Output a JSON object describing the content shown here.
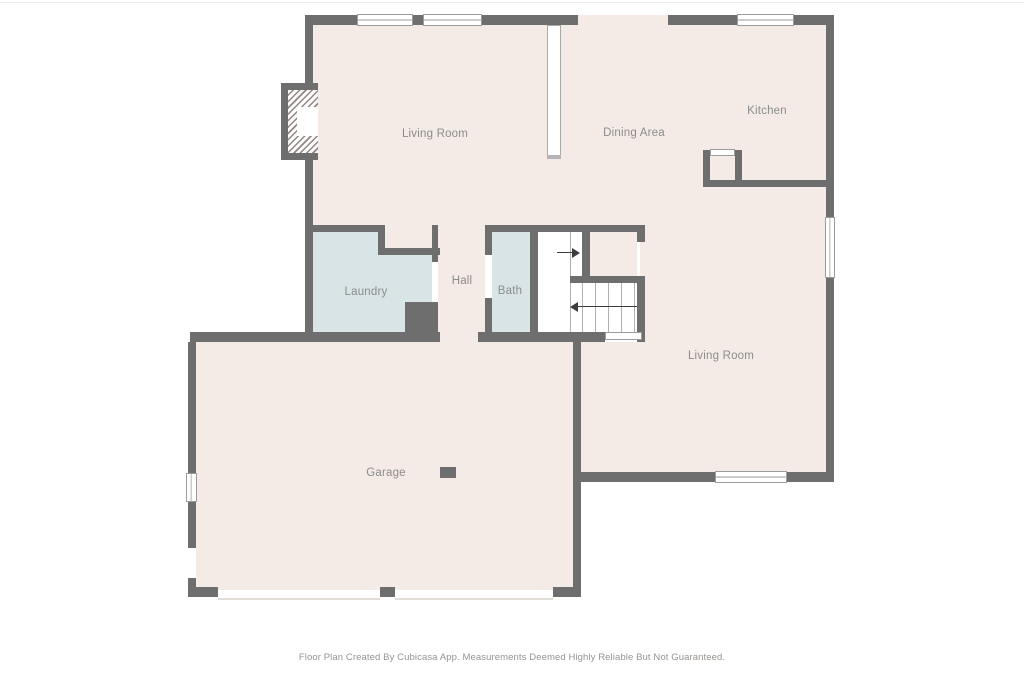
{
  "rooms": {
    "living_room_main": {
      "label": "Living Room"
    },
    "dining_area": {
      "label": "Dining Area"
    },
    "kitchen": {
      "label": "Kitchen"
    },
    "laundry": {
      "label": "Laundry"
    },
    "hall": {
      "label": "Hall"
    },
    "bath": {
      "label": "Bath"
    },
    "living_room_lower": {
      "label": "Living Room"
    },
    "garage": {
      "label": "Garage"
    }
  },
  "footer": {
    "text": "Floor Plan Created By Cubicasa App. Measurements Deemed Highly Reliable But Not Guaranteed."
  },
  "colors": {
    "wall": "#6e6e6e",
    "floor": "#f4ebe6",
    "wet": "#d8e4e6",
    "outline": "#9c9c9c",
    "label": "#8c8c8c",
    "stairline": "#b0b0b0",
    "arrow": "#3c3c3c",
    "doorline": "#e3ddd8",
    "background": "#ffffff",
    "topline": "#ededed"
  }
}
